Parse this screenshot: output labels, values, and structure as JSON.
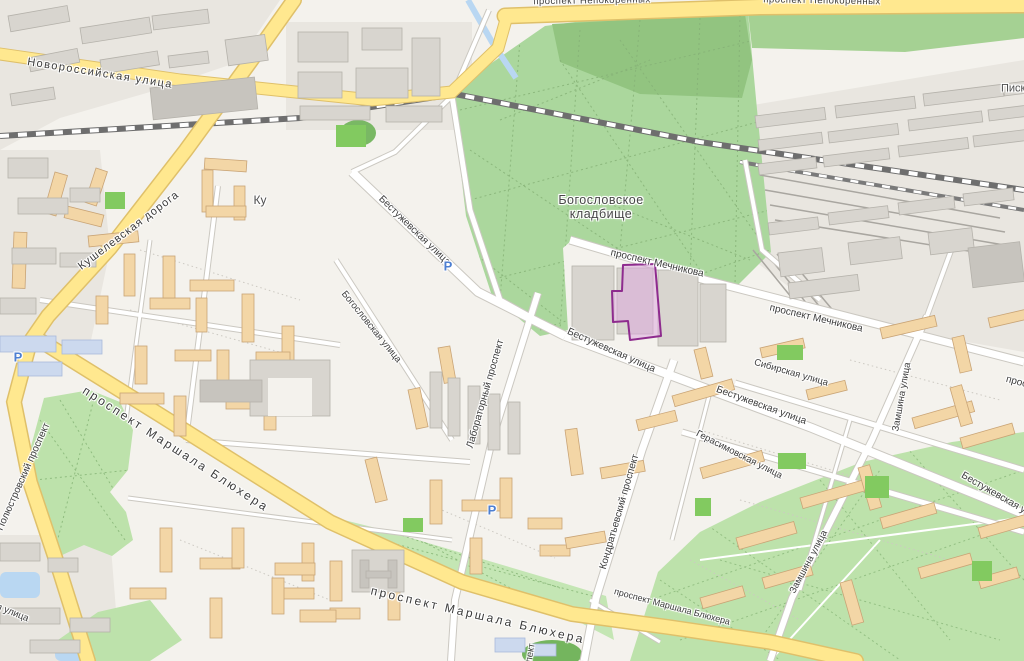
{
  "map": {
    "colors": {
      "background": "#f4f2ed",
      "industrial_zone": "#e9e6e0",
      "cemetery_green": "#abd79d",
      "cemetery_dark_green": "#92c480",
      "park_green": "#bde2ab",
      "field_green": "#82ca60",
      "road_major_fill": "#ffe88f",
      "road_major_border": "#dfc06a",
      "road_minor_fill": "#ffffff",
      "road_minor_border": "#cbc8c1",
      "railway_dark": "#4a4a4a",
      "water_blue": "#b9d7f2",
      "building_residential": "#f3d6a6",
      "building_residential_border": "#c9a476",
      "building_gray": "#d8d5cf",
      "building_gray_border": "#b5b2ab",
      "building_blue": "#ccd9ee",
      "label_text": "#3c3c3c",
      "parking_blue": "#4d7fd1",
      "highlight_fill": "#dda9dd",
      "highlight_border": "#8e2b8e"
    },
    "labels": [
      {
        "id": "street-label-novorossiyskaya",
        "text": "Новороссийская улица",
        "x": 100,
        "y": 74,
        "rotate": 9,
        "size": 11,
        "spacing": 1.5
      },
      {
        "id": "street-label-kushelevskaya",
        "text": "Кушелевская дорога",
        "x": 129,
        "y": 231,
        "rotate": -37,
        "size": 11,
        "spacing": 1
      },
      {
        "id": "street-label-nepokorennykh-left",
        "text": "проспект Непокорённых",
        "x": 592,
        "y": 1,
        "rotate": -1,
        "size": 9.5,
        "spacing": 0.5
      },
      {
        "id": "street-label-nepokorennykh-right",
        "text": "проспект Непокорённых",
        "x": 822,
        "y": 1,
        "rotate": 1,
        "size": 9.5,
        "spacing": 0.5
      },
      {
        "id": "place-label-ku",
        "text": "Ку",
        "x": 260,
        "y": 200,
        "rotate": 0,
        "size": 12,
        "color": "#4f4f4f"
      },
      {
        "id": "place-label-bogoslovskoe-line1",
        "text": "Богословское",
        "x": 601,
        "y": 200,
        "rotate": 0,
        "size": 12.5,
        "color": "#474747",
        "spacing": 0.5
      },
      {
        "id": "place-label-bogoslovskoe-line2",
        "text": "кладбище",
        "x": 601,
        "y": 214,
        "rotate": 0,
        "size": 12.5,
        "color": "#474747",
        "spacing": 0.5
      },
      {
        "id": "street-label-mechnikova-1",
        "text": "проспект Мечникова",
        "x": 657,
        "y": 264,
        "rotate": 13,
        "size": 10
      },
      {
        "id": "street-label-mechnikova-2",
        "text": "проспект Мечникова",
        "x": 816,
        "y": 319,
        "rotate": 13,
        "size": 10
      },
      {
        "id": "street-label-mechnikova-cut",
        "text": "проспект Мечникова",
        "x": 1052,
        "y": 392,
        "rotate": 15,
        "size": 10
      },
      {
        "id": "street-label-bestuzhevskaya-1",
        "text": "Бестужевская улица",
        "x": 414,
        "y": 231,
        "rotate": 44,
        "size": 10
      },
      {
        "id": "street-label-bestuzhevskaya-2",
        "text": "Бестужевская улица",
        "x": 611,
        "y": 351,
        "rotate": 24,
        "size": 10
      },
      {
        "id": "street-label-bestuzhevskaya-3",
        "text": "Бестужевская улица",
        "x": 761,
        "y": 406,
        "rotate": 20,
        "size": 10
      },
      {
        "id": "street-label-bestuzhevskaya-4",
        "text": "Бестужевская улица",
        "x": 1003,
        "y": 499,
        "rotate": 30,
        "size": 10
      },
      {
        "id": "street-label-sibirskaya",
        "text": "Сибирская улица",
        "x": 791,
        "y": 373,
        "rotate": 16,
        "size": 9.5
      },
      {
        "id": "street-label-gerasimovskaya",
        "text": "Герасимовская улица",
        "x": 739,
        "y": 455,
        "rotate": 27,
        "size": 9.5
      },
      {
        "id": "street-label-bogoslovskaya",
        "text": "Богословская улица",
        "x": 371,
        "y": 327,
        "rotate": 51,
        "size": 9.5
      },
      {
        "id": "street-label-laboratorny",
        "text": "Лабораторный проспект",
        "x": 486,
        "y": 394,
        "rotate": -74,
        "size": 10
      },
      {
        "id": "street-label-kondratievsky",
        "text": "Кондратьевский проспект",
        "x": 620,
        "y": 512,
        "rotate": -74,
        "size": 10
      },
      {
        "id": "street-label-zamshina-1",
        "text": "Замшина улица",
        "x": 902,
        "y": 397,
        "rotate": -80,
        "size": 9.5
      },
      {
        "id": "street-label-zamshina-2",
        "text": "Замшина улица",
        "x": 809,
        "y": 562,
        "rotate": -62,
        "size": 9.5
      },
      {
        "id": "road-label-blyukhera-1",
        "text": "проспект Маршала Блюхера",
        "x": 176,
        "y": 449,
        "rotate": 33,
        "size": 12,
        "spacing": 2.5
      },
      {
        "id": "road-label-blyukhera-2",
        "text": "проспект Маршала Блюхера",
        "x": 478,
        "y": 615,
        "rotate": 13,
        "size": 12,
        "spacing": 2.5
      },
      {
        "id": "street-label-blyukhera-small",
        "text": "проспект Маршала Блюхера",
        "x": 672,
        "y": 607,
        "rotate": 15,
        "size": 9
      },
      {
        "id": "road-label-polyustrovsky",
        "text": "Полюстровский проспект",
        "x": 24,
        "y": 477,
        "rotate": -66,
        "size": 10
      },
      {
        "id": "street-label-cut-bottom-left",
        "text": "ая улица",
        "x": 10,
        "y": 612,
        "rotate": 22,
        "size": 9.5
      },
      {
        "id": "place-label-piskaryovka",
        "text": "Пискарёвка",
        "x": 1031,
        "y": 89,
        "rotate": 0,
        "size": 11,
        "color": "#4f4f4f"
      },
      {
        "id": "street-label-cut-bottom-center",
        "text": "проспект",
        "x": 529,
        "y": 663,
        "rotate": -80,
        "size": 9.5
      }
    ],
    "parking_glyph": "Р",
    "parking_markers": [
      {
        "x": 18,
        "y": 357
      },
      {
        "x": 448,
        "y": 266
      },
      {
        "x": 492,
        "y": 510
      }
    ],
    "highlight": {
      "id": "selected-building-highlight",
      "points": "623,265 655,264 661,336 630,340 628,321 613,322 612,291 622,291",
      "fill": "#dda9dd",
      "fill_opacity": 0.55,
      "stroke": "#8e2b8e",
      "stroke_width": 2
    }
  }
}
